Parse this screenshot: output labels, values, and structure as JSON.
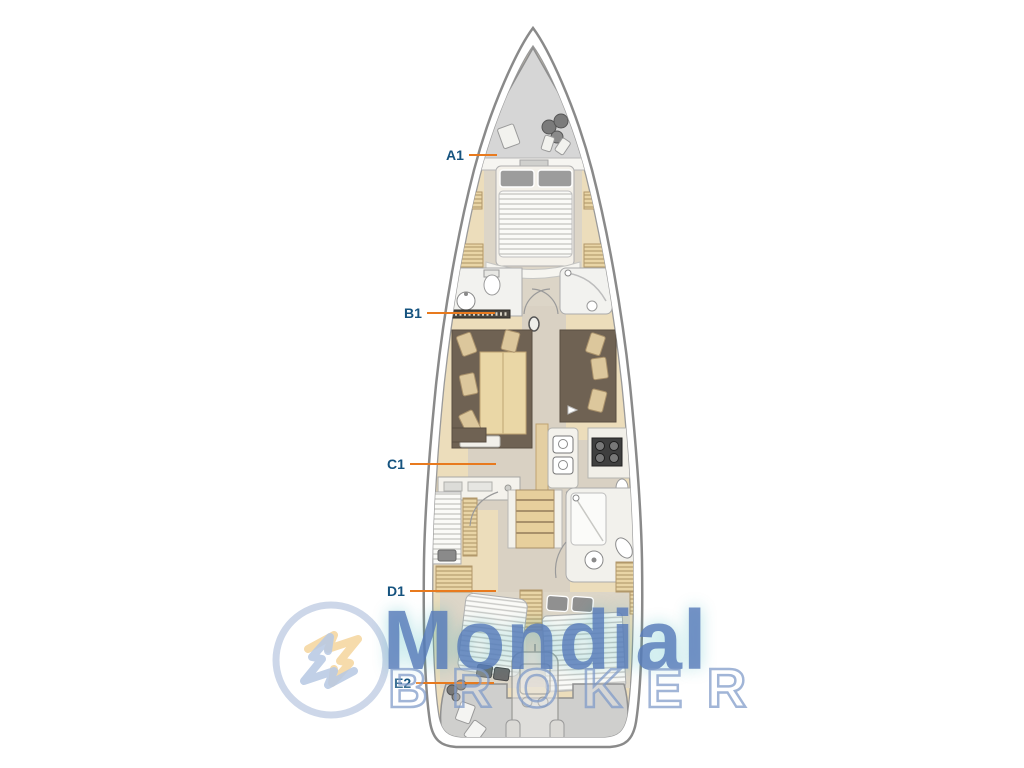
{
  "page": {
    "width": 1024,
    "height": 768,
    "background": "#ffffff",
    "content": "sailing-yacht-interior-deck-plan"
  },
  "plan": {
    "labels": [
      {
        "text": "A1"
      },
      {
        "text": "B1"
      },
      {
        "text": "C1"
      },
      {
        "text": "D1"
      },
      {
        "text": "E2"
      }
    ],
    "label_color": "#15537f",
    "leader_color": "#e87a1e",
    "hull_wood_color": "#ecddbb",
    "floor_color": "#d9d1c3",
    "sofa_color": "#6f6253",
    "locker_gray": "#d6d6d6"
  },
  "watermark": {
    "brand_top": "Mondial",
    "brand_bottom": "BROKER",
    "logo_icon": "mondial-broker-star-logo",
    "blue": "#5b82c0",
    "yellow": "#f2cd8a"
  }
}
